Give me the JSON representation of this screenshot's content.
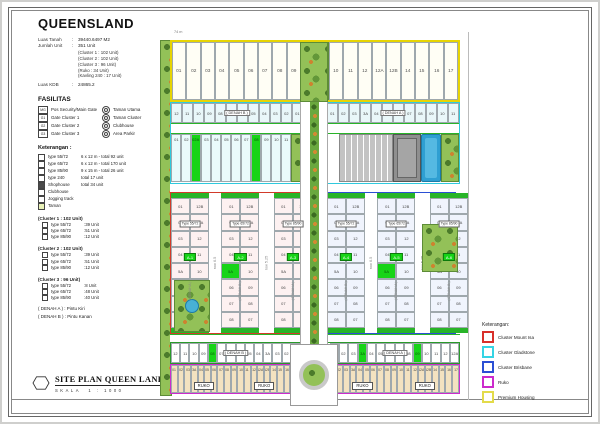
{
  "sidebar": {
    "title": "QUEENSLAND",
    "info": {
      "rows": [
        {
          "label": "Luas Tanah",
          "value": "39440.6497 M2"
        },
        {
          "label": "Jumlah Unit",
          "value": "351 Unit"
        }
      ],
      "breakdown": [
        "(Cluster 1 : 102 Unit)",
        "(Cluster 2 : 102 Unit)",
        "(Cluster 3 : 96 Unit)",
        "(Ruko : 34 Unit)",
        "(Kavling 240 : 17 Unit)"
      ],
      "kdb": {
        "label": "Luas KDB",
        "value": "24865.2"
      }
    },
    "fasilitas": {
      "heading": "FASILITAS",
      "left": [
        {
          "icon": "MG",
          "label": "Pos Security/Main Gate"
        },
        {
          "icon": "G1",
          "label": "Gate Cluster 1"
        },
        {
          "icon": "G2",
          "label": "Gate Cluster 2"
        },
        {
          "icon": "G3",
          "label": "Gate Cluster 3"
        }
      ],
      "right": [
        {
          "label": "Taman Utama"
        },
        {
          "label": "Taman Cluster"
        },
        {
          "label": "Clubhouse"
        },
        {
          "label": "Area Parkir"
        }
      ]
    },
    "keterangan": {
      "heading": "Keterangan :",
      "items": [
        {
          "swatch": "#ffffff",
          "label": "type 55/72",
          "desc": "6 x 12 m - total 92 unit"
        },
        {
          "swatch": "#ffffff",
          "label": "type 65/72",
          "desc": "6 x 12 m - total 170 unit"
        },
        {
          "swatch": "#ffffff",
          "label": "type 85/90",
          "desc": "9 x 15 m - total 26 unit"
        },
        {
          "swatch": "#ffffff",
          "label": "type 240",
          "desc": "total 17 unit"
        },
        {
          "swatch": "#4a4a4a",
          "label": "Shophouse",
          "desc": "total 34 unit"
        },
        {
          "swatch": "#ffffff",
          "label": "Clubhouse",
          "desc": ""
        },
        {
          "swatch": "#ffffff",
          "label": "Jogging track",
          "desc": ""
        },
        {
          "swatch": "#e9f2b8",
          "label": "Taman",
          "desc": ""
        }
      ]
    },
    "clusters": [
      {
        "title": "(Cluster 1 : 102 Unit)",
        "rows": [
          {
            "label": "type 55/72",
            "value": "39 Unit"
          },
          {
            "label": "type 65/72",
            "value": "51 Unit"
          },
          {
            "label": "type 85/90",
            "value": "12 Unit"
          }
        ]
      },
      {
        "title": "(Cluster 2 : 102 Unit)",
        "rows": [
          {
            "label": "type 55/72",
            "value": "39 Unit"
          },
          {
            "label": "type 65/72",
            "value": "51 Unit"
          },
          {
            "label": "type 85/90",
            "value": "12 Unit"
          }
        ]
      },
      {
        "title": "(Cluster 3 : 96 Unit)",
        "rows": [
          {
            "label": "type 55/72",
            "value": "8 Unit"
          },
          {
            "label": "type 65/72",
            "value": "48 Unit"
          },
          {
            "label": "type 85/90",
            "value": "40 Unit"
          }
        ]
      }
    ],
    "denah": [
      {
        "label": "( DENAH A )",
        "value": "Pintu Kiri"
      },
      {
        "label": "( DENAH B )",
        "value": "Pintu Kanan"
      }
    ]
  },
  "titleblock": {
    "title": "SITE PLAN QUEEN LAND",
    "scale_label": "SKALA",
    "scale_value": "1 : 1000"
  },
  "legend": {
    "heading": "Keterangan:",
    "items": [
      {
        "color": "#d8302a",
        "label": "Cluster Mount Isa"
      },
      {
        "color": "#35d4e4",
        "label": "Cluster Gladstone"
      },
      {
        "color": "#2b4fd4",
        "label": "Cluster Brisbane"
      },
      {
        "color": "#cc2bcc",
        "label": "Ruko"
      },
      {
        "color": "#e3db4a",
        "label": "Premium Housing"
      }
    ]
  },
  "plan": {
    "premium_left": [
      "01",
      "02",
      "03",
      "04",
      "05",
      "06",
      "07",
      "08",
      "09"
    ],
    "premium_right": [
      "10",
      "11",
      "12",
      "12A",
      "12B",
      "14",
      "15",
      "16",
      "17"
    ],
    "cyan_left": [
      "12",
      "11",
      "10",
      "09",
      "08",
      "07",
      "06",
      "05",
      "04",
      "03",
      "02",
      "01"
    ],
    "cyan_right": [
      "01",
      "02",
      "03",
      "3A",
      "04",
      "05",
      "06",
      "07",
      "08",
      "09",
      "10",
      "11"
    ],
    "denah_a": "( DENAH A )",
    "denah_b": "( DENAH B )",
    "glad_lots": [
      "01",
      "02",
      "02A",
      "03",
      "04",
      "05",
      "06",
      "07",
      "08",
      "09",
      "10",
      "11"
    ],
    "stack_a": [
      "01",
      "02",
      "03",
      "04",
      "5A",
      "06",
      "07",
      "08"
    ],
    "stack_b": [
      "12B",
      "12A",
      "12",
      "11",
      "10",
      "09",
      "08",
      "07"
    ],
    "block_labels": [
      "A-1",
      "A-2",
      "A-3",
      "A-4",
      "A-5",
      "A-6"
    ],
    "type_chips": [
      "Type 55/72",
      "Type 65/72",
      "Type 85/90"
    ],
    "bottom_left": [
      "12",
      "11",
      "10",
      "09",
      "08",
      "07",
      "06",
      "5A",
      "05",
      "04",
      "3A",
      "03",
      "02",
      "01"
    ],
    "bottom_right": [
      "01",
      "02",
      "03",
      "3A",
      "04",
      "05",
      "06",
      "07",
      "08",
      "09",
      "10",
      "11",
      "12",
      "12A"
    ],
    "ruko_lots": [
      "01",
      "02",
      "03",
      "3A",
      "04",
      "05",
      "06",
      "07",
      "08",
      "09",
      "10",
      "11",
      "12",
      "12A",
      "12B",
      "14",
      "15",
      "16",
      "17"
    ],
    "ruko_label": "RUKO",
    "gates": {
      "glad": [
        2,
        8
      ],
      "bottom_left": [
        5
      ],
      "bottom_right": [
        4,
        10
      ],
      "stack_rows": [
        4
      ]
    },
    "roads": {
      "row8": "row 8",
      "row7": "row 7",
      "row525": "row 5.25",
      "row610": "row 6.10",
      "row65": "row 6.5",
      "row85": "row 8.5"
    },
    "dims": {
      "top": "74 m"
    }
  }
}
